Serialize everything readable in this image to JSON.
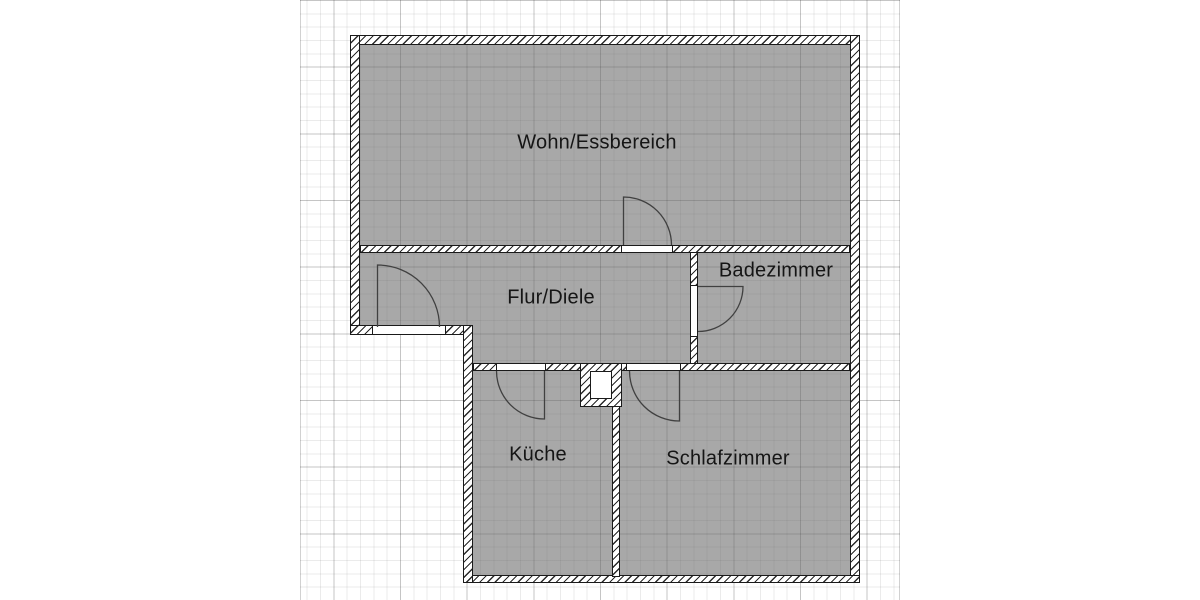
{
  "floor_plan": {
    "rooms": [
      {
        "id": "wohn",
        "label": "Wohn/Essbereich"
      },
      {
        "id": "flur",
        "label": "Flur/Diele"
      },
      {
        "id": "bad",
        "label": "Badezimmer"
      },
      {
        "id": "kueche",
        "label": "Küche"
      },
      {
        "id": "schlaf",
        "label": "Schlafzimmer"
      }
    ],
    "doors": [
      {
        "id": "entrance-door",
        "swings_into": "Flur/Diele"
      },
      {
        "id": "wohn-door",
        "swings_into": "Wohn/Essbereich"
      },
      {
        "id": "bad-door",
        "swings_into": "Badezimmer"
      },
      {
        "id": "kueche-door",
        "swings_into": "Küche"
      },
      {
        "id": "schlaf-door",
        "swings_into": "Schlafzimmer"
      }
    ],
    "colors": {
      "background": "#ffffff",
      "room_fill": "#a8a8a8",
      "wall_line": "#1a1a1a",
      "door_line": "#404040",
      "grid_minor": "#e8e8e8",
      "grid_major": "#cfcfcf"
    }
  }
}
